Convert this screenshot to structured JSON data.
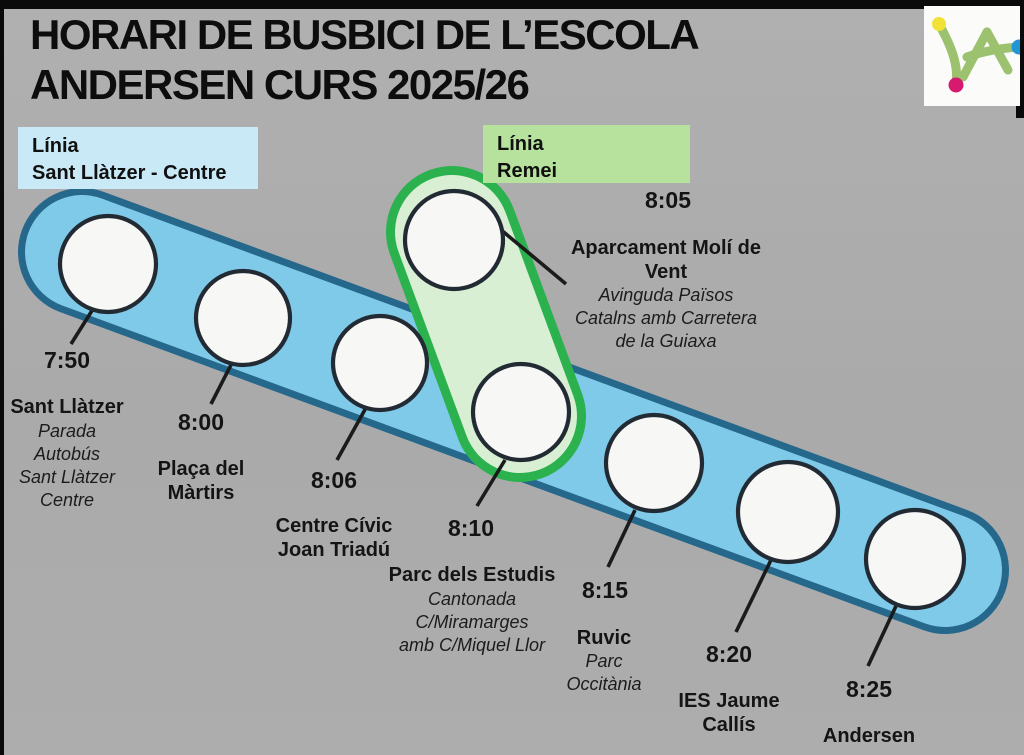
{
  "title": "HORARI DE BUSBICI DE L’ESCOLA\nANDERSEN CURS 2025/26",
  "legend": {
    "blue": {
      "label": "Línia\nSant Llàtzer - Centre",
      "color": "#c9e9f7"
    },
    "green": {
      "label": "Línia\nRemei",
      "color": "#b6e29e"
    }
  },
  "routes": [
    {
      "id": "sant-llatzer-centre",
      "name": "Línia Sant Llàtzer - Centre",
      "fill": "#7fc9e9",
      "border": "#26688c"
    },
    {
      "id": "remei",
      "name": "Línia Remei",
      "fill": "#d9efd3",
      "border": "#2bb24f"
    }
  ],
  "stops": [
    {
      "route": "sant-llatzer-centre",
      "time": "7:50",
      "name": "Sant Llàtzer",
      "desc": "Parada\nAutobús\nSant Llàtzer\nCentre"
    },
    {
      "route": "sant-llatzer-centre",
      "time": "8:00",
      "name": "Plaça del\nMàrtirs",
      "desc": ""
    },
    {
      "route": "sant-llatzer-centre",
      "time": "8:06",
      "name": "Centre Cívic\nJoan Triadú",
      "desc": ""
    },
    {
      "route": "sant-llatzer-centre",
      "time": "8:10",
      "name": "Parc dels Estudis",
      "desc": "Cantonada\nC/Miramarges\namb C/Miquel Llor"
    },
    {
      "route": "sant-llatzer-centre",
      "time": "8:15",
      "name": "Ruvic",
      "desc": "Parc\nOccitània"
    },
    {
      "route": "sant-llatzer-centre",
      "time": "8:20",
      "name": "IES Jaume\nCallís",
      "desc": ""
    },
    {
      "route": "sant-llatzer-centre",
      "time": "8:25",
      "name": "Andersen",
      "desc": ""
    },
    {
      "route": "remei",
      "time": "8:05",
      "name": "Aparcament Molí de\nVent",
      "desc": "Avinguda Països\nCatalns amb Carretera\nde la Guiaxa"
    }
  ],
  "colors": {
    "background": "#ababab",
    "stop_circle_fill": "#f7f7f5",
    "stop_circle_border": "#222b33",
    "callout_line": "#1b1b1b",
    "logo_green": "#9cc16f",
    "logo_yellow": "#f2e136",
    "logo_magenta": "#d61a6f",
    "logo_blue": "#2196d6"
  }
}
